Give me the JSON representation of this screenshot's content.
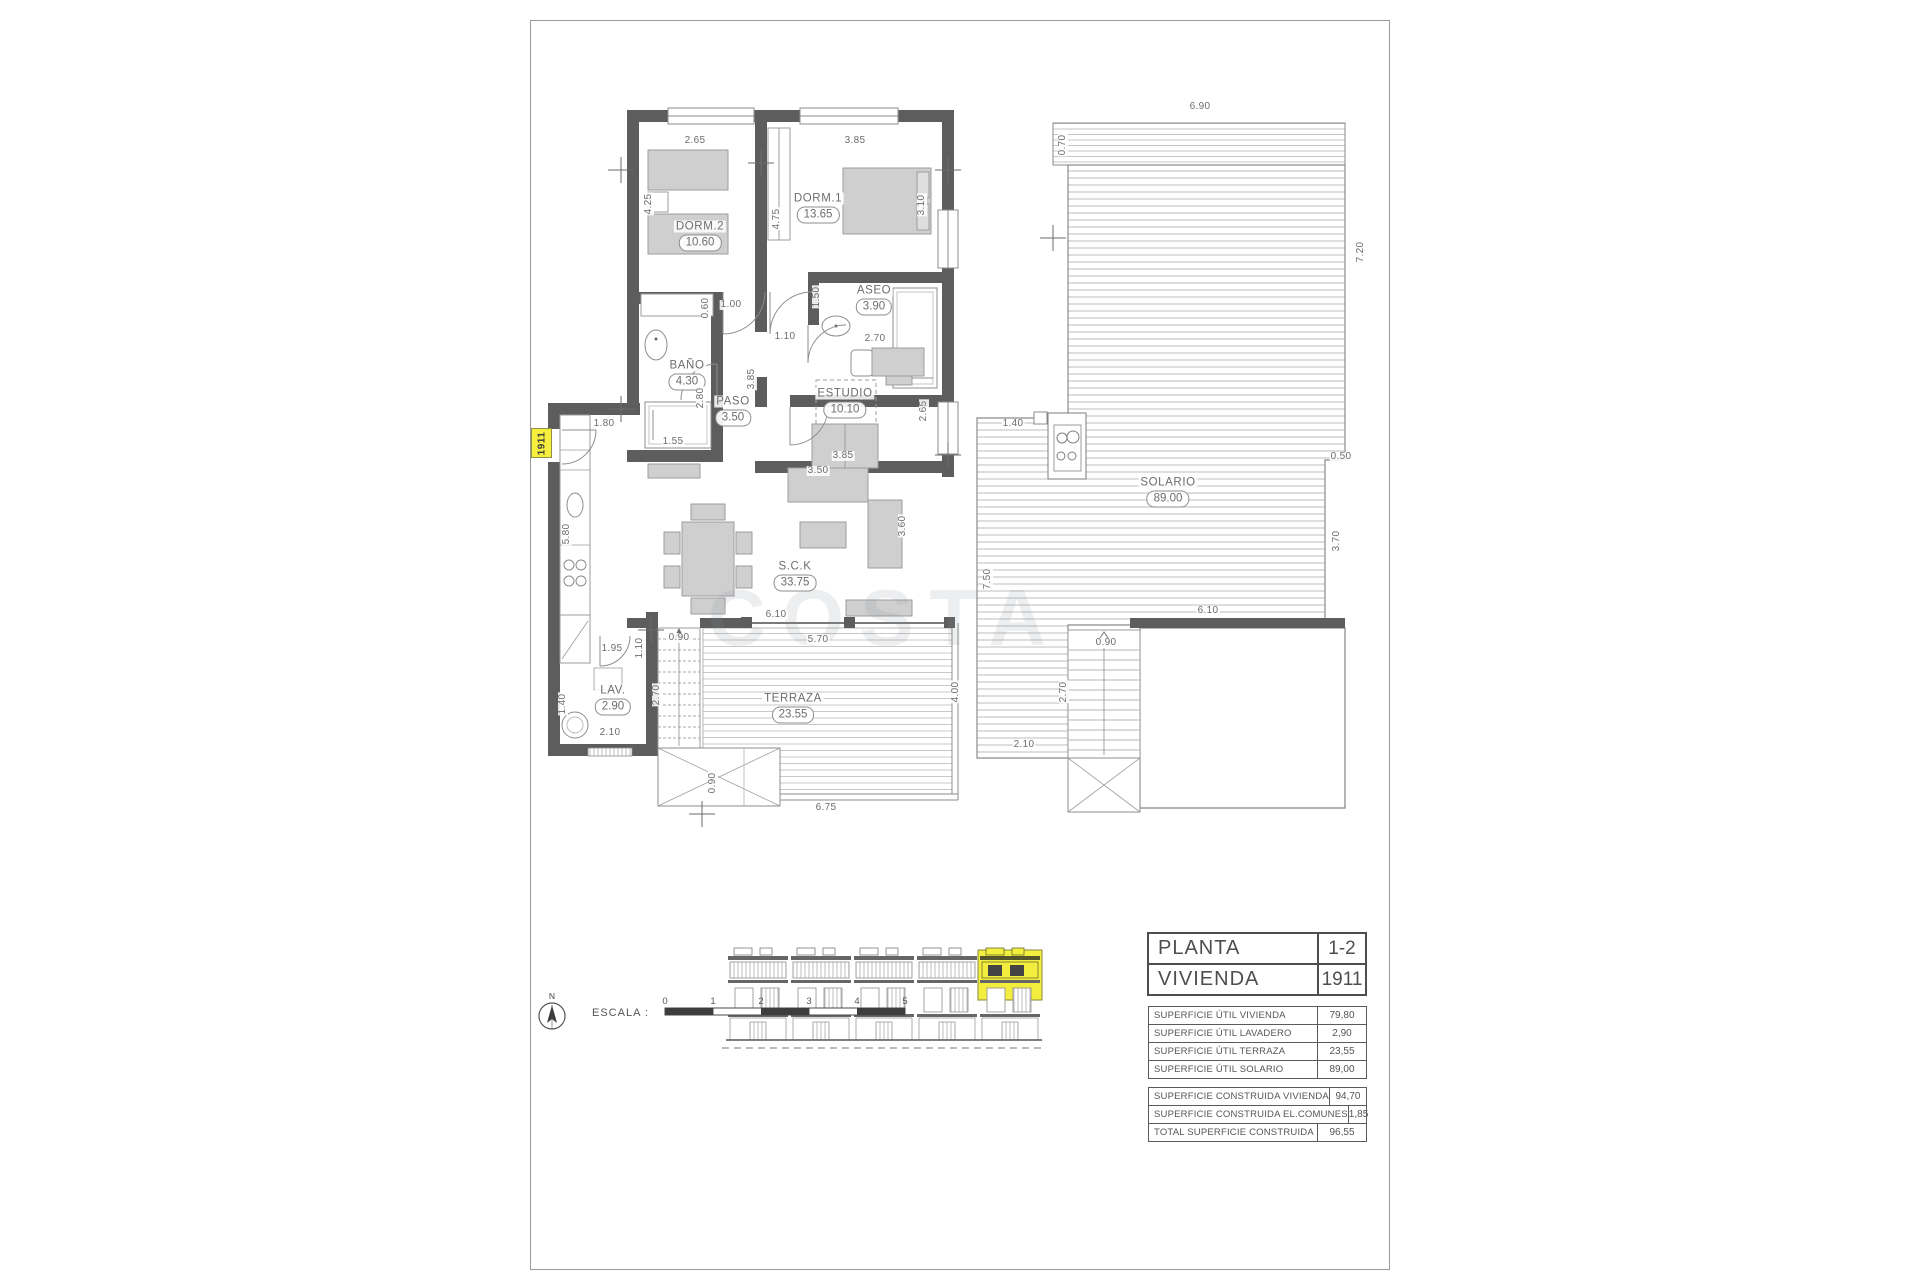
{
  "sheet": {
    "type": "architectural-floor-plan"
  },
  "colors": {
    "wall": "#5d5d5d",
    "highlight": "#f3ee3e",
    "line": "#7a7a7a",
    "text": "#6d6d6d"
  },
  "watermark": "COSTA",
  "unit_tag": "1911",
  "north": "N",
  "scale": {
    "label": "ESCALA :",
    "ticks": [
      "0",
      "1",
      "2",
      "3",
      "4",
      "5"
    ]
  },
  "plan": {
    "rooms": [
      {
        "name": "DORM.2",
        "area": "10.60",
        "x": 700,
        "y": 236
      },
      {
        "name": "DORM.1",
        "area": "13.65",
        "x": 818,
        "y": 208
      },
      {
        "name": "ASEO",
        "area": "3.90",
        "x": 874,
        "y": 300
      },
      {
        "name": "BAÑO",
        "area": "4.30",
        "x": 687,
        "y": 375
      },
      {
        "name": "PASO",
        "area": "3.50",
        "x": 733,
        "y": 411
      },
      {
        "name": "ESTUDIO",
        "area": "10.10",
        "x": 845,
        "y": 403
      },
      {
        "name": "S.C.K",
        "area": "33.75",
        "x": 795,
        "y": 576
      },
      {
        "name": "LAV.",
        "area": "2.90",
        "x": 613,
        "y": 700
      },
      {
        "name": "TERRAZA",
        "area": "23.55",
        "x": 793,
        "y": 708
      },
      {
        "name": "SOLARIO",
        "area": "89.00",
        "x": 1168,
        "y": 492
      }
    ],
    "dimensions": [
      {
        "t": "2.65",
        "x": 695,
        "y": 141
      },
      {
        "t": "3.85",
        "x": 855,
        "y": 141
      },
      {
        "t": "4.25",
        "x": 649,
        "y": 204,
        "v": 1
      },
      {
        "t": "4.75",
        "x": 777,
        "y": 219,
        "v": 1
      },
      {
        "t": "3.10",
        "x": 922,
        "y": 205,
        "v": 1
      },
      {
        "t": "0.60",
        "x": 706,
        "y": 308,
        "v": 1
      },
      {
        "t": "1.00",
        "x": 731,
        "y": 305
      },
      {
        "t": "1.50",
        "x": 817,
        "y": 297,
        "v": 1
      },
      {
        "t": "1.10",
        "x": 785,
        "y": 337
      },
      {
        "t": "2.70",
        "x": 875,
        "y": 339
      },
      {
        "t": "3.85",
        "x": 752,
        "y": 379,
        "v": 1
      },
      {
        "t": "2.80",
        "x": 701,
        "y": 398,
        "v": 1
      },
      {
        "t": "1.80",
        "x": 604,
        "y": 424
      },
      {
        "t": "1.55",
        "x": 673,
        "y": 442
      },
      {
        "t": "3.50",
        "x": 818,
        "y": 471
      },
      {
        "t": "3.85",
        "x": 843,
        "y": 456
      },
      {
        "t": "2.65",
        "x": 924,
        "y": 411,
        "v": 1
      },
      {
        "t": "3.60",
        "x": 903,
        "y": 526,
        "v": 1
      },
      {
        "t": "5.80",
        "x": 567,
        "y": 534,
        "v": 1
      },
      {
        "t": "1.95",
        "x": 612,
        "y": 649
      },
      {
        "t": "1.10",
        "x": 640,
        "y": 648,
        "v": 1
      },
      {
        "t": "0.90",
        "x": 679,
        "y": 638
      },
      {
        "t": "1.40",
        "x": 563,
        "y": 704,
        "v": 1
      },
      {
        "t": "2.10",
        "x": 610,
        "y": 733
      },
      {
        "t": "2.70",
        "x": 657,
        "y": 695,
        "v": 1
      },
      {
        "t": "0.90",
        "x": 713,
        "y": 783,
        "v": 1
      },
      {
        "t": "6.10",
        "x": 776,
        "y": 615
      },
      {
        "t": "5.70",
        "x": 818,
        "y": 640
      },
      {
        "t": "6.75",
        "x": 826,
        "y": 808
      },
      {
        "t": "4.00",
        "x": 956,
        "y": 692,
        "v": 1
      },
      {
        "t": "6.90",
        "x": 1200,
        "y": 107
      },
      {
        "t": "0.70",
        "x": 1063,
        "y": 145,
        "v": 1
      },
      {
        "t": "7.20",
        "x": 1361,
        "y": 252,
        "v": 1
      },
      {
        "t": "0.50",
        "x": 1341,
        "y": 457
      },
      {
        "t": "1.40",
        "x": 1013,
        "y": 424
      },
      {
        "t": "7.50",
        "x": 988,
        "y": 579,
        "v": 1
      },
      {
        "t": "3.70",
        "x": 1337,
        "y": 541,
        "v": 1
      },
      {
        "t": "6.10",
        "x": 1208,
        "y": 611
      },
      {
        "t": "0.90",
        "x": 1106,
        "y": 643
      },
      {
        "t": "2.70",
        "x": 1064,
        "y": 692,
        "v": 1
      },
      {
        "t": "2.10",
        "x": 1024,
        "y": 745
      }
    ]
  },
  "info_table": {
    "main_rows": [
      {
        "label": "PLANTA",
        "value": "1-2"
      },
      {
        "label": "VIVIENDA",
        "value": "1911"
      }
    ],
    "util_rows": [
      {
        "label": "SUPERFICIE ÚTIL VIVIENDA",
        "value": "79,80"
      },
      {
        "label": "SUPERFICIE ÚTIL LAVADERO",
        "value": "2,90"
      },
      {
        "label": "SUPERFICIE ÚTIL TERRAZA",
        "value": "23,55"
      },
      {
        "label": "SUPERFICIE ÚTIL SOLARIO",
        "value": "89,00"
      }
    ],
    "built_rows": [
      {
        "label": "SUPERFICIE CONSTRUIDA VIVIENDA",
        "value": "94,70"
      },
      {
        "label": "SUPERFICIE CONSTRUIDA EL.COMUNES",
        "value": "1,85"
      },
      {
        "label": "TOTAL SUPERFICIE CONSTRUIDA",
        "value": "96,55"
      }
    ]
  }
}
